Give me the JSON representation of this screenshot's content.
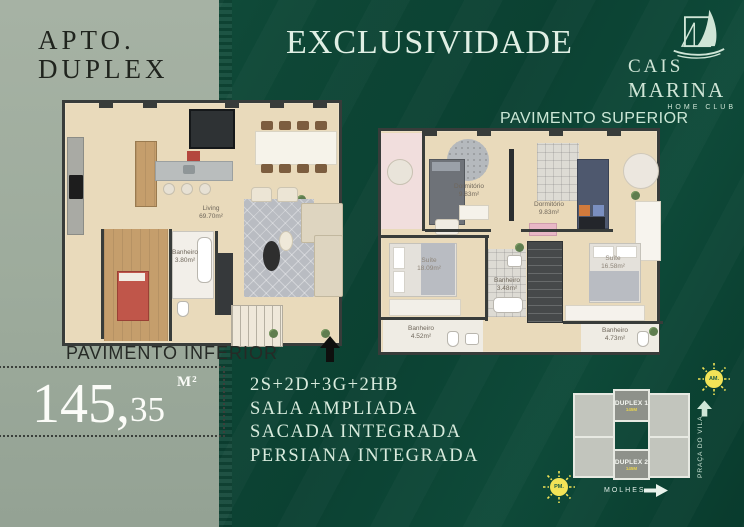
{
  "brand": {
    "apto_line1": "APTO.",
    "apto_line2": "DUPLEX",
    "title": "EXCLUSIVIDADE",
    "logo_line1": "CAIS",
    "logo_line2": "MARINA",
    "logo_sub": "HOME CLUB"
  },
  "plan_inferior": {
    "label": "PAVIMENTO INFERIOR",
    "rooms": {
      "living": {
        "name": "Living",
        "area": "69.70m²"
      },
      "banheiro": {
        "name": "Banheiro",
        "area": "3.80m²"
      }
    }
  },
  "plan_superior": {
    "label": "PAVIMENTO SUPERIOR",
    "rooms": {
      "dormitorio1": {
        "name": "Dormitório",
        "area": "9.83m²"
      },
      "dormitorio2": {
        "name": "Dormitório",
        "area": "9.83m²"
      },
      "suite1": {
        "name": "Suíte",
        "area": "18.09m²"
      },
      "suite2": {
        "name": "Suíte",
        "area": "16.58m²"
      },
      "banheiro1": {
        "name": "Banheiro",
        "area": "3.48m²"
      },
      "banheiro2": {
        "name": "Banheiro",
        "area": "4.52m²"
      },
      "banheiro3": {
        "name": "Banheiro",
        "area": "4.73m²"
      }
    }
  },
  "area_badge": {
    "value": "145,",
    "decimals": "35",
    "unit": "M²"
  },
  "features": {
    "line1": "2S+2D+3G+2HB",
    "line2": "SALA AMPLIADA",
    "line3": "SACADA INTEGRADA",
    "line4": "PERSIANA INTEGRADA"
  },
  "site_map": {
    "duplex1_label": "DUPLEX 1",
    "duplex1_sub": "145M",
    "duplex2_label": "DUPLEX 2",
    "duplex2_sub": "145M",
    "sun_am": "AM.",
    "sun_pm": "PM.",
    "street_vertical": "PRAÇA DO VILA",
    "street_bottom": "MOLHES"
  },
  "colors": {
    "dark_green": "#0d4636",
    "sage": "#9dab9c",
    "gold": "#b18c4e",
    "mint": "#d8ebdd",
    "sun_yellow": "#f2e357"
  }
}
